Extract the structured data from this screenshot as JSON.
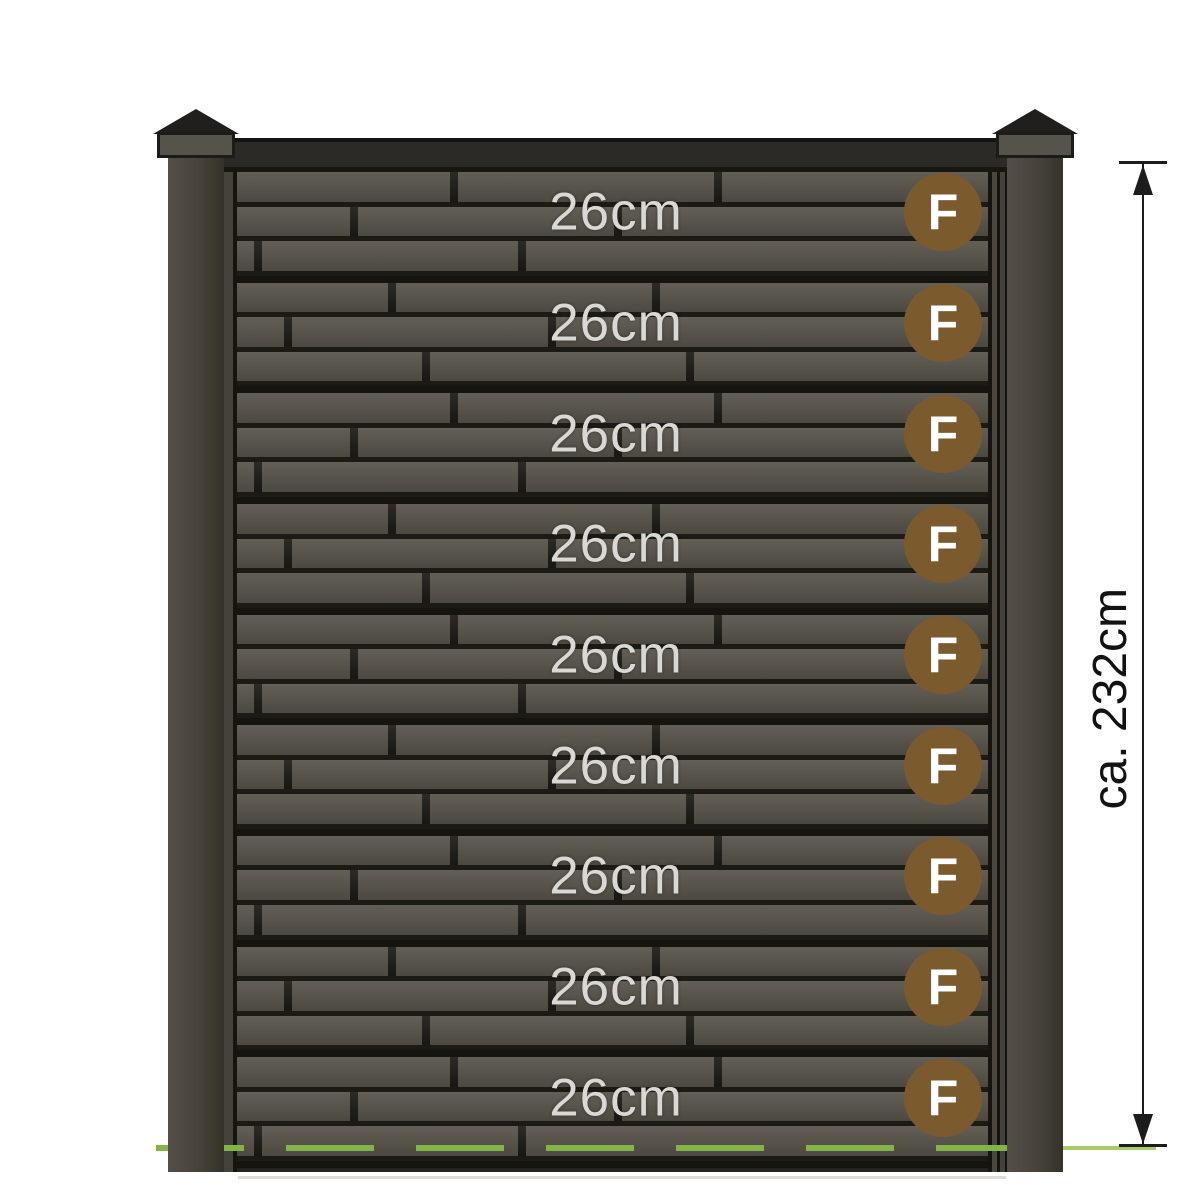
{
  "diagram": {
    "fence": {
      "rows": [
        {
          "height_label": "26cm",
          "badge_label": "F"
        },
        {
          "height_label": "26cm",
          "badge_label": "F"
        },
        {
          "height_label": "26cm",
          "badge_label": "F"
        },
        {
          "height_label": "26cm",
          "badge_label": "F"
        },
        {
          "height_label": "26cm",
          "badge_label": "F"
        },
        {
          "height_label": "26cm",
          "badge_label": "F"
        },
        {
          "height_label": "26cm",
          "badge_label": "F"
        },
        {
          "height_label": "26cm",
          "badge_label": "F"
        },
        {
          "height_label": "26cm",
          "badge_label": "F"
        }
      ],
      "row_count": 9
    },
    "dimension": {
      "label": "ca. 232cm"
    },
    "colors": {
      "badge_brown": "#7b5a2d",
      "board_olive": "#57534a",
      "gap_dark": "#1b1a15",
      "ground_green": "#82b546",
      "label_gray": "#d9d8d4"
    }
  }
}
